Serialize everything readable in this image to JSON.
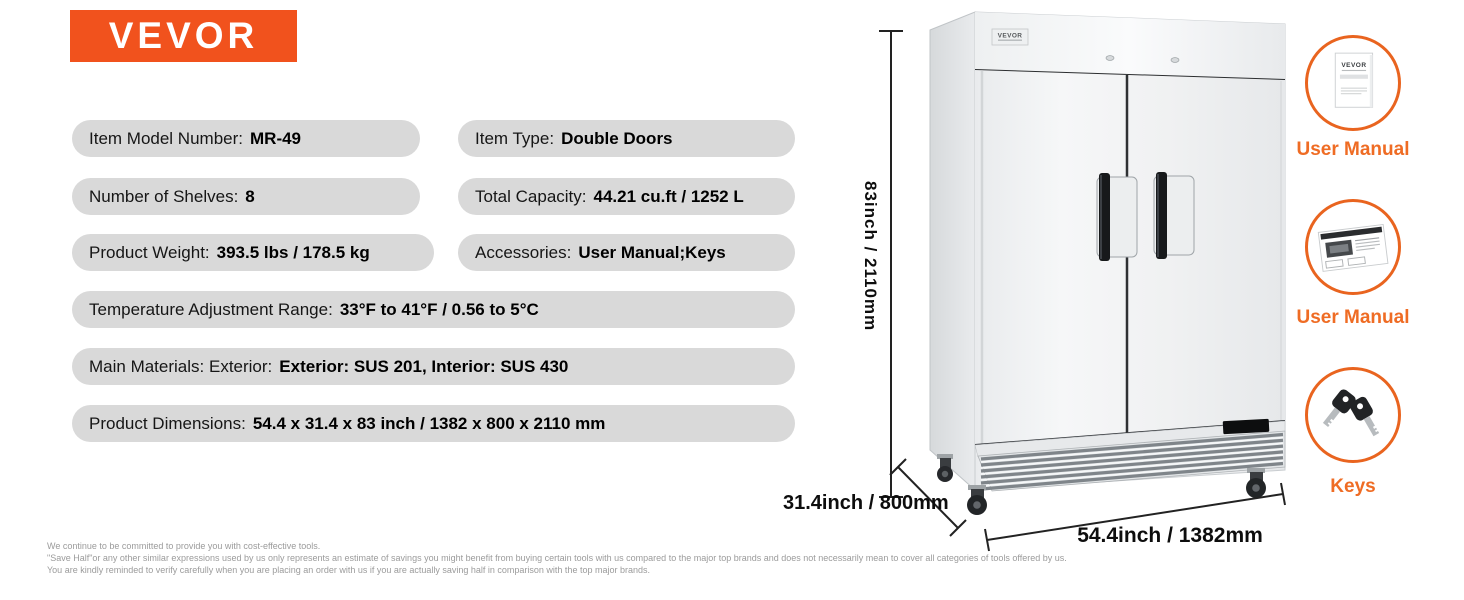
{
  "brand": {
    "logo_text": "VEVOR"
  },
  "colors": {
    "brand_orange": "#f1521d",
    "accent_ring_orange": "#e9641f",
    "accent_label_orange": "#ef6c24",
    "pill_gray": "#d9d9d9"
  },
  "specs": [
    {
      "label": "Item Model Number:",
      "value": "MR-49"
    },
    {
      "label": "Item Type:",
      "value": "Double Doors"
    },
    {
      "label": "Number of Shelves:",
      "value": "8"
    },
    {
      "label": "Total Capacity:",
      "value": "44.21 cu.ft / 1252 L"
    },
    {
      "label": "Product Weight:",
      "value": "393.5 lbs / 178.5 kg"
    },
    {
      "label": "Accessories:",
      "value": "User Manual;Keys"
    },
    {
      "label": "Temperature Adjustment Range:",
      "value": "33°F to 41°F / 0.56 to 5°C"
    },
    {
      "label": "Main Materials: Exterior:",
      "value": "Exterior: SUS 201, Interior: SUS 430"
    },
    {
      "label": "Product Dimensions:",
      "value": "54.4 x 31.4 x 83 inch / 1382 x 800 x 2110 mm"
    }
  ],
  "dimensions": {
    "height": "83inch / 2110mm",
    "depth": "31.4inch / 800mm",
    "width": "54.4inch / 1382mm"
  },
  "fridge": {
    "badge_text": "VEVOR"
  },
  "accessories": [
    {
      "label": "User Manual",
      "doc_title": "VEVOR"
    },
    {
      "label": "User Manual"
    },
    {
      "label": "Keys"
    }
  ],
  "footnotes": [
    "We continue to be committed to provide you with cost-effective tools.",
    "\"Save Half\"or any other similar expressions used by us only represents an estimate of savings you might benefit from buying certain tools with us compared to the major top brands and does not necessarily mean to cover all categories of tools offered by us.",
    "You are kindly reminded to verify carefully when you are placing an order with us if you are actually saving half in comparison with the top major brands."
  ]
}
